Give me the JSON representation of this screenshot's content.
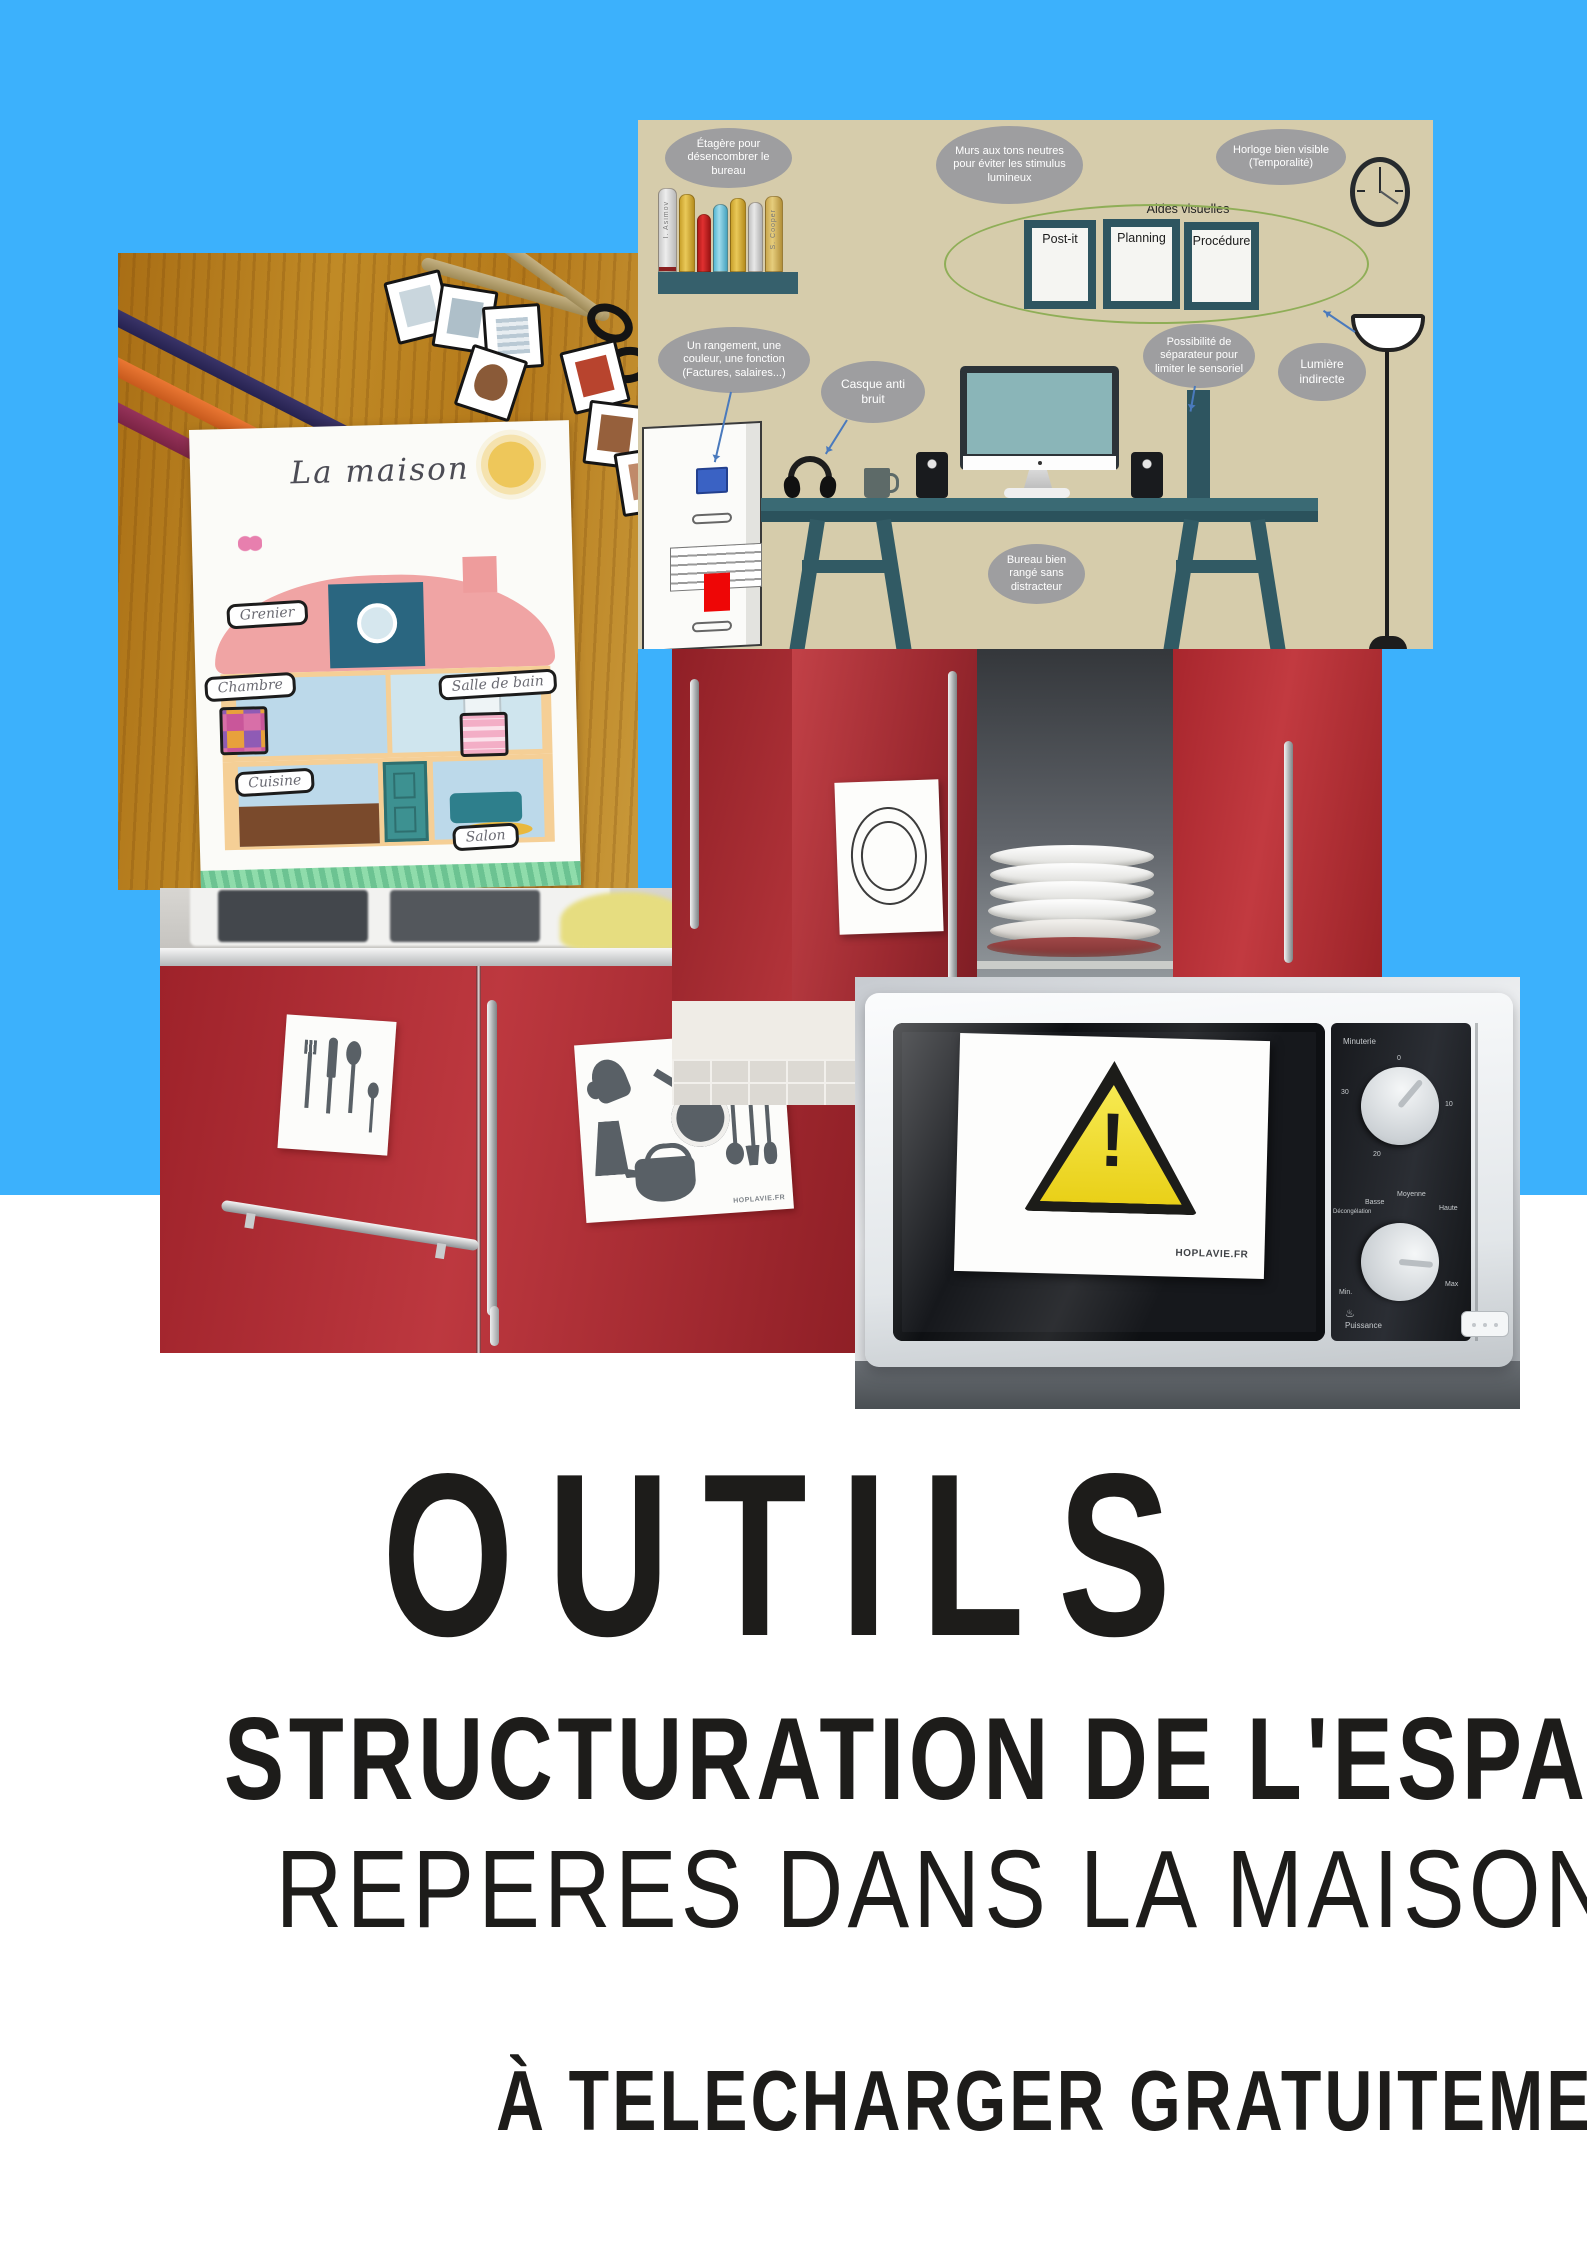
{
  "poster": {
    "line1": "OUTILS",
    "line2": "STRUCTURATION DE L'ESPACE",
    "line3": "REPERES DANS LA MAISON",
    "line4": "À TELECHARGER GRATUITEMENT"
  },
  "colors": {
    "background_top": "#3cb1fc",
    "background_bottom": "#ffffff",
    "title_text": "#1d1c1a",
    "diagram_background": "#d6ccab",
    "bubble_grey": "#9e9ea0",
    "cabinet_red": "#a8242c",
    "warning_yellow": "#eed81c",
    "desk_teal": "#2e5560"
  },
  "workspace_diagram": {
    "bubbles": {
      "shelf": "Étagère pour désencombrer le bureau",
      "walls": "Murs aux tons neutres pour éviter les stimulus lumineux",
      "clock": "Horloge bien visible (Temporalité)",
      "storage": "Un rangement, une couleur, une fonction (Factures, salaires...)",
      "headset": "Casque anti bruit",
      "separator": "Possibilité de séparateur pour limiter le sensoriel",
      "light": "Lumière indirecte",
      "desk": "Bureau bien rangé sans distracteur"
    },
    "visual_aids": {
      "label": "Aides visuelles",
      "panels": [
        "Post-it",
        "Planning",
        "Procédure"
      ]
    },
    "book_spines": [
      "I. Asimov",
      "S. Cooper"
    ]
  },
  "maison_sheet": {
    "title": "La maison",
    "rooms": [
      "Grenier",
      "Chambre",
      "Salle de bain",
      "Cuisine",
      "Salon"
    ]
  },
  "kitchen_cards": {
    "brand": "HOPLAVIE.FR"
  },
  "microwave_panel": {
    "timer_label": "Minuterie",
    "timer_ticks": [
      "0",
      "10",
      "20",
      "30"
    ],
    "power_label": "Puissance",
    "power_icon": "♨",
    "power_levels": {
      "defrost": "Décongélation",
      "low": "Basse",
      "medium": "Moyenne",
      "high": "Haute",
      "min": "Min.",
      "max": "Max"
    },
    "warning_brand": "HOPLAVIE.FR",
    "warning_exclamation": "!"
  }
}
